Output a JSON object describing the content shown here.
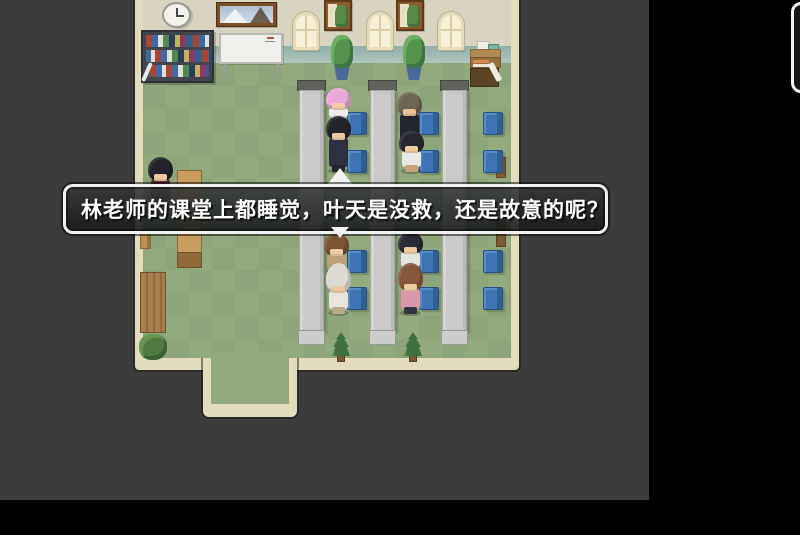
{
  "dialogue": {
    "text": "林老师的课堂上都睡觉，叶天是没救，还是故意的呢？"
  },
  "colors": {
    "letterbox": "#000000",
    "game_background": "#3c3c3c",
    "floor": "#93aa7e",
    "wall": "#d9d4c0",
    "baseboard": "#a3bdb4",
    "wall_trim": "#e3dbbd",
    "desk": "#c9c9c9",
    "chair_blue": "#3e74b4",
    "dialogue_border": "#f2f2f2",
    "dialogue_background": "rgba(32,34,36,0.85)"
  },
  "scene": {
    "desks": [
      {
        "x": 299
      },
      {
        "x": 370
      },
      {
        "x": 442
      }
    ],
    "chairs": [
      {
        "x": 347,
        "y": 112
      },
      {
        "x": 347,
        "y": 150
      },
      {
        "x": 347,
        "y": 250
      },
      {
        "x": 347,
        "y": 287
      },
      {
        "x": 419,
        "y": 112
      },
      {
        "x": 419,
        "y": 150
      },
      {
        "x": 419,
        "y": 250
      },
      {
        "x": 419,
        "y": 287
      },
      {
        "x": 483,
        "y": 112
      },
      {
        "x": 483,
        "y": 150
      },
      {
        "x": 483,
        "y": 250
      },
      {
        "x": 483,
        "y": 287
      }
    ],
    "windows": [
      {
        "x": 293
      },
      {
        "x": 367
      },
      {
        "x": 438
      }
    ],
    "wall_frames": [
      {
        "x": 324
      },
      {
        "x": 396
      }
    ],
    "pot_plants": [
      {
        "x": 331
      },
      {
        "x": 403
      }
    ],
    "pine_plants": [
      {
        "x": 330
      },
      {
        "x": 402
      }
    ],
    "characters": [
      {
        "name": "student-pink-hair",
        "x": 325,
        "y": 88,
        "h": 34,
        "hairH": 22,
        "hair": "#e7a8d8",
        "outfit": "#ececec",
        "legs": "#d8d8d8",
        "skin": "#f0cda6"
      },
      {
        "name": "student-black-hair-front",
        "x": 325,
        "y": 116,
        "h": 56,
        "hairH": 24,
        "hair": "#23232b",
        "outfit": "#2c3040",
        "legs": "#23232b",
        "skin": "#ecc9a0"
      },
      {
        "name": "teacher-buzz-cut",
        "x": 396,
        "y": 92,
        "h": 58,
        "hairH": 24,
        "hair": "#6e6554",
        "outfit": "#23252d",
        "legs": "#23252d",
        "skin": "#e6c096"
      },
      {
        "name": "student-black-hair-girl",
        "x": 398,
        "y": 131,
        "h": 41,
        "hairH": 22,
        "hair": "#272730",
        "outfit": "#e8e8e8",
        "legs": "#caa27a",
        "skin": "#eccaa2"
      },
      {
        "name": "student-brown-hair",
        "x": 323,
        "y": 233,
        "h": 39,
        "hairH": 23,
        "hair": "#7b5433",
        "outfit": "#bfa177",
        "legs": "#8a7050",
        "skin": "#eccaa2"
      },
      {
        "name": "student-white-hair",
        "x": 325,
        "y": 263,
        "h": 51,
        "hairH": 30,
        "hair": "#dcdad2",
        "outfit": "#e8e5da",
        "legs": "#b8a88c",
        "skin": "#eccaa2"
      },
      {
        "name": "student-black-hair-girl-2",
        "x": 397,
        "y": 232,
        "h": 40,
        "hairH": 22,
        "hair": "#2b2b34",
        "outfit": "#e4e4e4",
        "legs": "#3a3a44",
        "skin": "#eccaa2"
      },
      {
        "name": "student-auburn-hair",
        "x": 397,
        "y": 263,
        "h": 51,
        "hairH": 28,
        "hair": "#85563c",
        "outfit": "#d898aa",
        "legs": "#33333d",
        "skin": "#eccaa2"
      },
      {
        "name": "student-left-black-hair",
        "x": 147,
        "y": 157,
        "h": 47,
        "hairH": 24,
        "hair": "#23232b",
        "outfit": "#5e2e3c",
        "legs": "#2a2a33",
        "skin": "#eccaa2"
      }
    ]
  }
}
